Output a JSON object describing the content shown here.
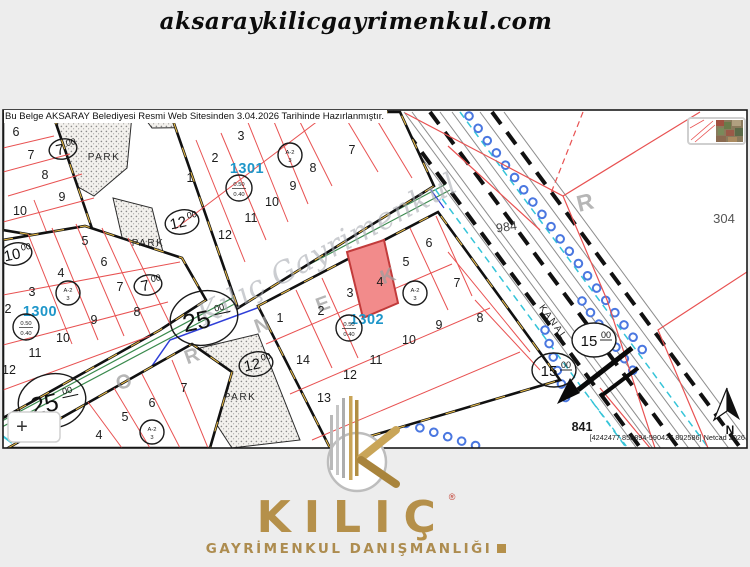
{
  "site": {
    "url": "aksaraykilicgayrimenkul.com"
  },
  "map": {
    "notice": "Bu Belge AKSARAY Belediyesi Resmi Web Sitesinden 3.04.2026 Tarihinde Hazırlanmıştır.",
    "watermark": "Kılıç Gayrimenkul",
    "street_letters": {
      "l1": "O",
      "l2": "R",
      "l3": "N",
      "l4": "E",
      "l5": "K"
    },
    "letter_r": "R",
    "park_label": "PARK",
    "kanal_label": "KANAL",
    "north_label": "N",
    "plus_label": "+",
    "block_1300": {
      "label": "1300",
      "parcels": [
        "2",
        "3",
        "4",
        "5",
        "6",
        "7",
        "8",
        "9",
        "10",
        "11",
        "12"
      ]
    },
    "block_1301": {
      "label": "1301",
      "parcels": [
        "1",
        "2",
        "3",
        "7",
        "8",
        "9",
        "10",
        "11",
        "12"
      ]
    },
    "block_1302": {
      "label": "1302",
      "parcels": [
        "1",
        "2",
        "3",
        "4",
        "5",
        "6",
        "7",
        "8",
        "9",
        "10",
        "11",
        "12",
        "13",
        "14"
      ]
    },
    "block_topleft": {
      "parcels": [
        "6",
        "7",
        "8",
        "9",
        "10"
      ]
    },
    "block_bottomleft": {
      "parcels": [
        "4",
        "5",
        "6",
        "7"
      ]
    },
    "far_parcels": {
      "p304": "304",
      "p984": "984",
      "p841": "841"
    },
    "road_widths": {
      "w25": "25",
      "w15": "15",
      "w12": "12",
      "w10": "10",
      "w7": "7",
      "sup": "00"
    },
    "zoning": {
      "top": "A-2",
      "bottom": "3"
    },
    "ratio": {
      "top": "0.50",
      "bottom": "0.40"
    },
    "coords_text": "[4242477.858894-590427.802586] Netcad 2026",
    "highlight_color": "#f28b8b"
  },
  "footer": {
    "brand": "KILIÇ",
    "reg": "®",
    "tagline": "GAYRİMENKUL DANIŞMANLIĞI"
  }
}
